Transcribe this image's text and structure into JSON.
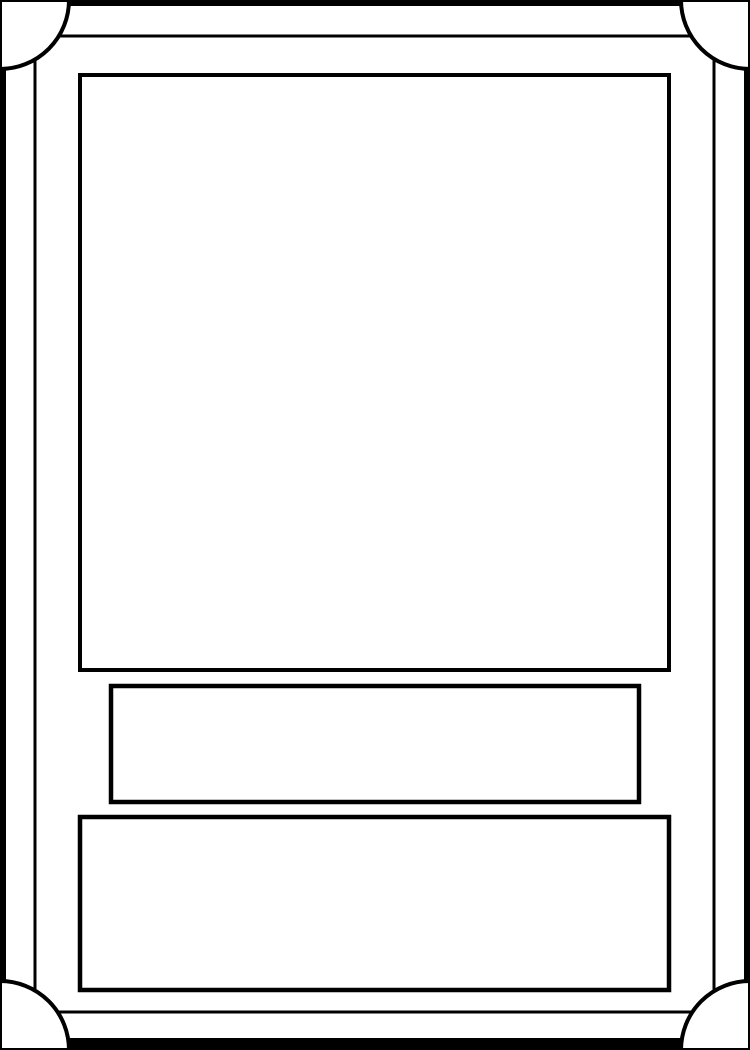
{
  "colors": {
    "card-border": "#000000",
    "card-surface": "#ffffff",
    "line": "#000000",
    "box-fill": "#ffffff"
  },
  "card": {
    "artwork_box": {
      "content": ""
    },
    "title_bar": {
      "content": ""
    },
    "description_box": {
      "content": ""
    }
  }
}
